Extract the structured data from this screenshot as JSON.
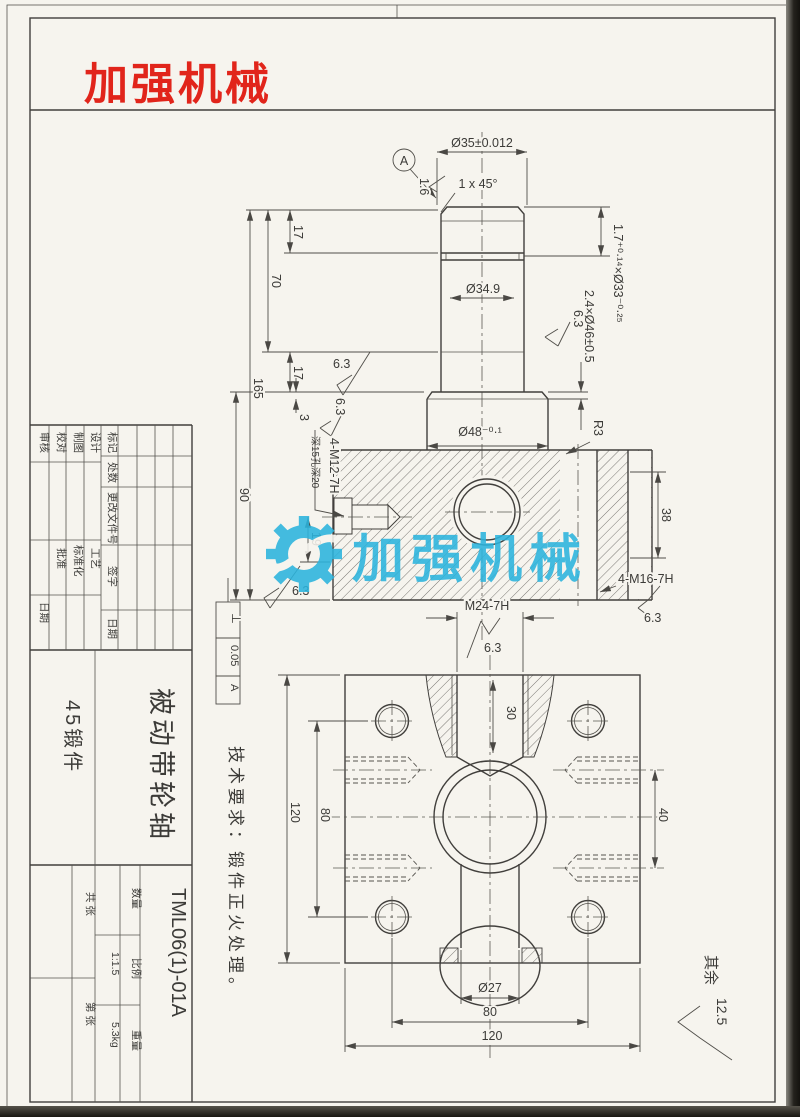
{
  "logo": {
    "text": "加强机械",
    "color": "#e1251b"
  },
  "watermark": {
    "text": "加强机械",
    "color": "#2bb4dd",
    "icon": "gear-icon"
  },
  "sheet": {
    "tech_req": "技术要求：锻件正火处理。",
    "other_prefix": "其余",
    "other_value": "12.5"
  },
  "front_view": {
    "datum": "A",
    "fin16": "1.6",
    "fin63": "6.3",
    "dims": {
      "dia35": "Ø35±0.012",
      "chamfer": "1 x 45°",
      "groove_top": "1.7⁺⁰·¹⁴×Ø33⁻⁰·²⁵",
      "groove_collar": "2.4×Ø46±0.5",
      "dia349": "Ø34.9",
      "dia48": "Ø48⁻⁰·¹",
      "r3": "R3",
      "d17a": "17",
      "d70": "70",
      "d17b": "17",
      "d3": "3",
      "d165": "165",
      "d90": "90",
      "d19": "19",
      "d38": "38"
    },
    "callouts": {
      "m12": "4-M12-7H",
      "m12_note": "深15孔深20",
      "m16": "4-M16-7H",
      "m24": "M24-7H"
    },
    "gdt": {
      "symbol": "⊥",
      "tolerance": "0.05",
      "datum": "A"
    }
  },
  "bottom_view": {
    "dims": {
      "d30": "30",
      "d40": "40",
      "h80": "80",
      "h120": "120",
      "w80": "80",
      "w120": "120",
      "dia27": "Ø27"
    }
  },
  "title_block": {
    "rev_headers": [
      "标记",
      "处数",
      "更改文件号",
      "签字",
      "日期"
    ],
    "roles_left": [
      "设计",
      "制图",
      "校对",
      "审核"
    ],
    "roles_mid": [
      "工艺",
      "标准化",
      "批准",
      "日期"
    ],
    "part_name": "被动带轮轴",
    "material": "45锻件",
    "drawing_no": "TML06(1)-01A",
    "qty_label": "数量",
    "scale_label": "比例",
    "scale_value": "1:1.5",
    "weight_label": "重量",
    "weight_value": "5.3kg",
    "sheet_total": "共 张",
    "sheet_no": "第 张"
  }
}
